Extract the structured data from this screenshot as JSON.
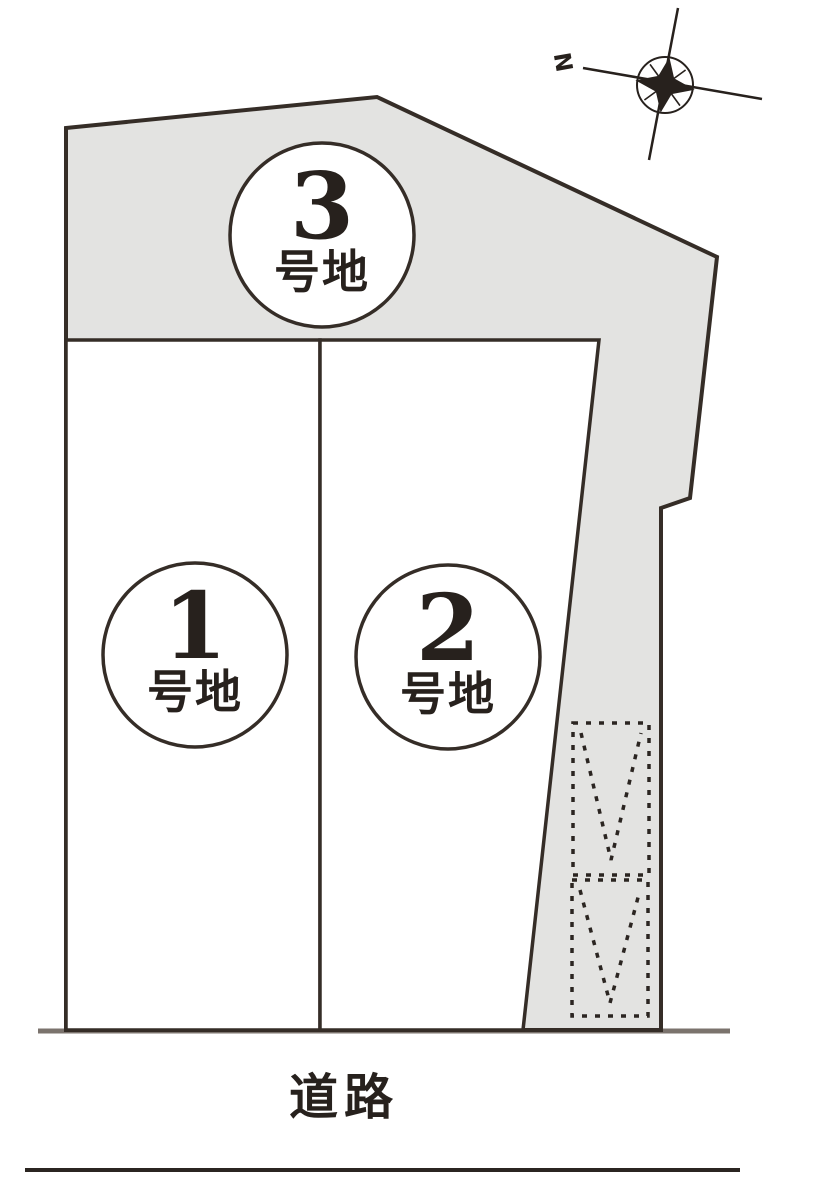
{
  "map": {
    "lots": [
      {
        "number": "1",
        "suffix": "号地"
      },
      {
        "number": "2",
        "suffix": "号地"
      },
      {
        "number": "3",
        "suffix": "号地"
      }
    ],
    "road_label": "道路",
    "compass_label": "N"
  },
  "colors": {
    "background": "#ffffff",
    "parcel_fill": "#e3e3e1",
    "lot_fill": "#ffffff",
    "outline": "#352d27",
    "dashed_box": "#2b2521",
    "road_line": "#7b736d",
    "bottom_line": "#2b2521",
    "text": "#27211d",
    "compass": "#27211d"
  }
}
